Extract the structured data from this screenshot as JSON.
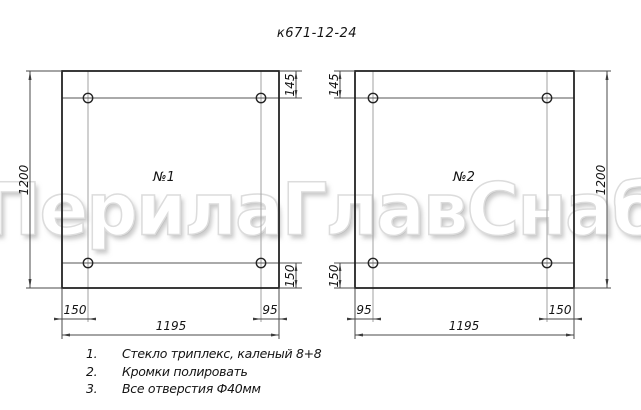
{
  "title": "к671-12-24",
  "watermark": {
    "text": "ПерилаГлавСнаб",
    "fill": "#ffffff",
    "outline": "#dcdcdc"
  },
  "panels": [
    {
      "label": "№1",
      "dims": {
        "height": "1200",
        "width": "1195",
        "top_hole_offset": "145",
        "bottom_hole_offset": "150",
        "left_hole_offset": "150",
        "right_hole_offset": "95"
      }
    },
    {
      "label": "№2",
      "dims": {
        "height": "1200",
        "width": "1195",
        "top_hole_offset": "145",
        "bottom_hole_offset": "150",
        "left_hole_offset": "95",
        "right_hole_offset": "150"
      }
    }
  ],
  "notes": [
    {
      "num": "1.",
      "text": "Стекло триплекс, каленый 8+8"
    },
    {
      "num": "2.",
      "text": "Кромки полировать"
    },
    {
      "num": "3.",
      "text": "Все отверстия Ф40мм"
    }
  ],
  "colors": {
    "background": "#ffffff",
    "border_line": "#242424",
    "thin_line": "#4a4a4a",
    "center_line": "#a2a2a2",
    "text": "#141414"
  }
}
